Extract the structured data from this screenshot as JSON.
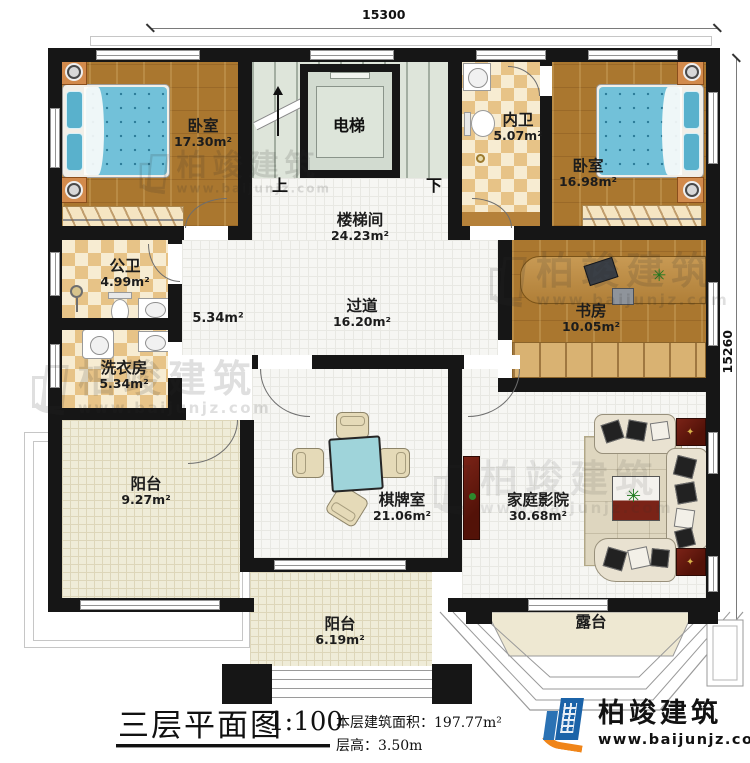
{
  "dimensions": {
    "top": "15300",
    "right": "15260"
  },
  "stair": {
    "up": "上",
    "down": "下",
    "elevator": "电梯"
  },
  "rooms": {
    "bedroom_left": {
      "label": "卧室",
      "area": "17.30m²"
    },
    "bedroom_right": {
      "label": "卧室",
      "area": "16.98m²"
    },
    "inner_bath": {
      "label": "内卫",
      "area": "5.07m²"
    },
    "stair_hall": {
      "label": "楼梯间",
      "area": "24.23m²"
    },
    "public_bath": {
      "label": "公卫",
      "area": "4.99m²"
    },
    "laundry": {
      "label": "洗衣房",
      "area": "5.34m²"
    },
    "hallway_area": {
      "area": "5.34m²"
    },
    "corridor": {
      "label": "过道",
      "area": "16.20m²"
    },
    "study": {
      "label": "书房",
      "area": "10.05m²"
    },
    "balcony_left": {
      "label": "阳台",
      "area": "9.27m²"
    },
    "chess_room": {
      "label": "棋牌室",
      "area": "21.06m²"
    },
    "home_theater": {
      "label": "家庭影院",
      "area": "30.68m²"
    },
    "balcony_bottom": {
      "label": "阳台",
      "area": "6.19m²"
    },
    "terrace": {
      "label": "露台"
    }
  },
  "title_block": {
    "title": "三层平面图",
    "scale": "1:100",
    "area_line": "本层建筑面积：197.77m²",
    "height_line": "层高：3.50m"
  },
  "brand": {
    "name": "柏竣建筑",
    "website": "www.baijunjz.com"
  },
  "colors": {
    "wall": "#161616",
    "logo_blue": "#1b63a8",
    "logo_orange": "#f08519",
    "bed_blue": "#72c1d9"
  }
}
